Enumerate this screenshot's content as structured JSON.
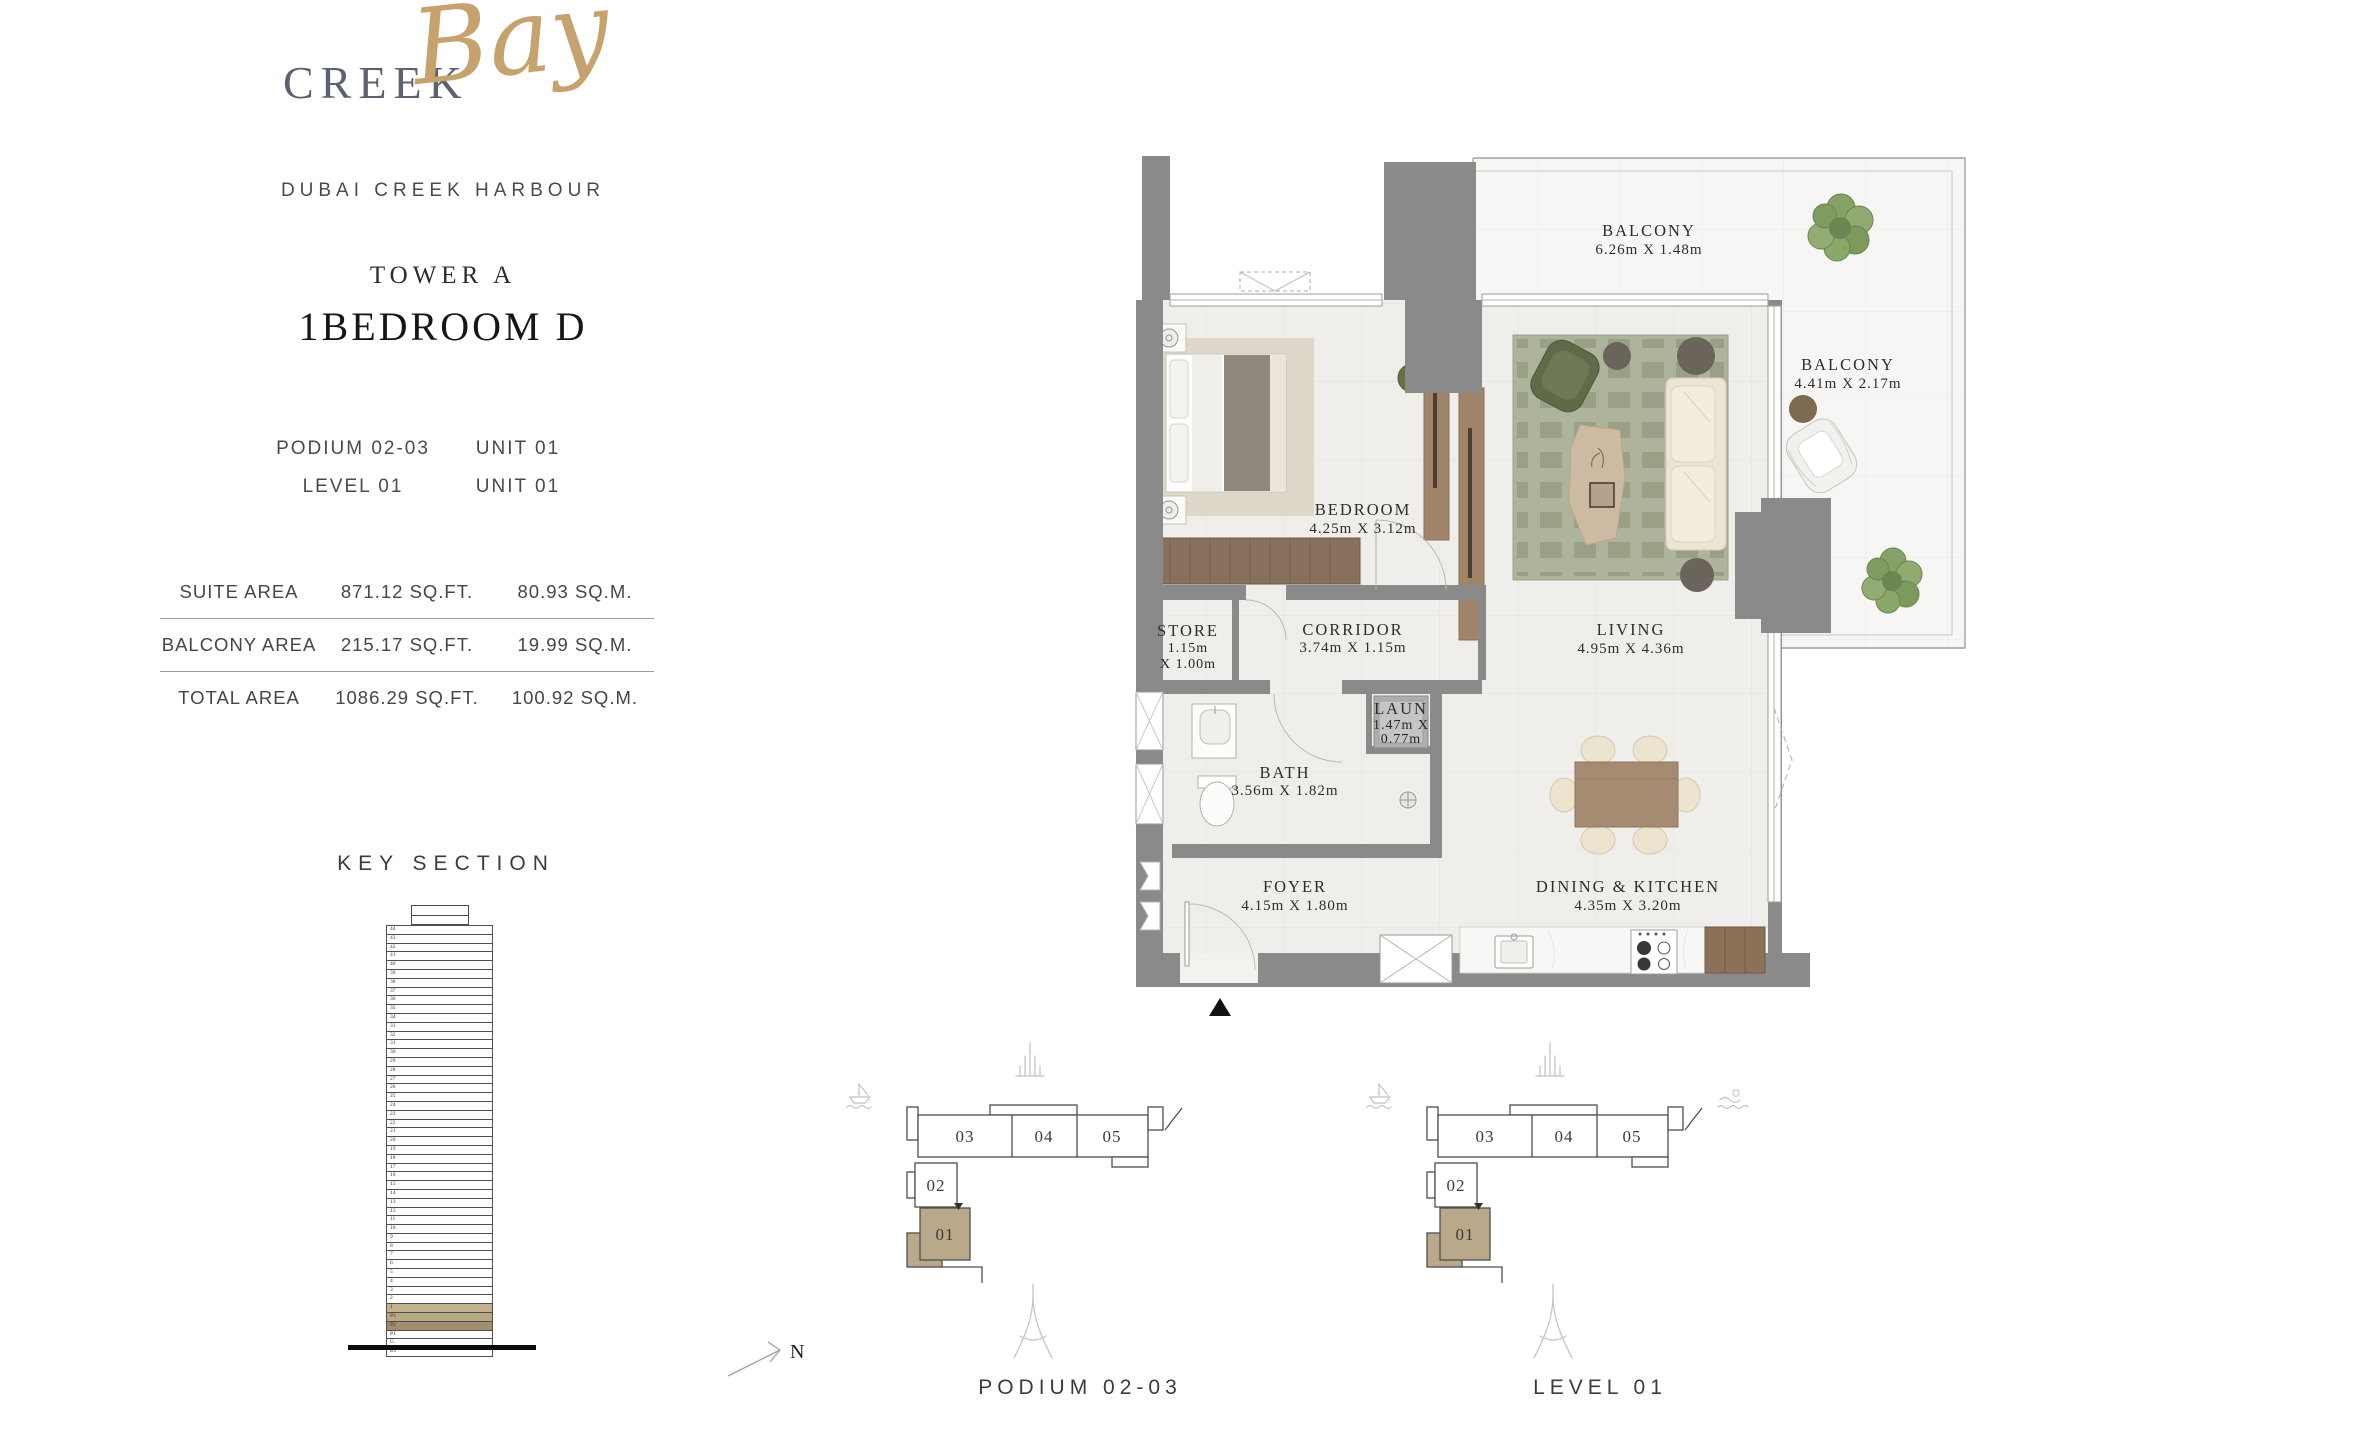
{
  "brand": {
    "name_primary": "CREEK",
    "name_script": "Bay",
    "subtitle": "DUBAI CREEK HARBOUR"
  },
  "unit": {
    "tower": "TOWER A",
    "type_label": "1BEDROOM D",
    "location_rows": [
      {
        "left": "PODIUM 02-03",
        "right": "UNIT 01"
      },
      {
        "left": "LEVEL 01",
        "right": "UNIT 01"
      }
    ]
  },
  "areas": {
    "rows": [
      {
        "label": "SUITE AREA",
        "sqft": "871.12 SQ.FT.",
        "sqm": "80.93 SQ.M."
      },
      {
        "label": "BALCONY AREA",
        "sqft": "215.17 SQ.FT.",
        "sqm": "19.99 SQ.M."
      },
      {
        "label": "TOTAL AREA",
        "sqft": "1086.29 SQ.FT.",
        "sqm": "100.92 SQ.M."
      }
    ]
  },
  "key_section": {
    "title": "KEY SECTION",
    "floors": [
      "44",
      "43",
      "42",
      "41",
      "40",
      "39",
      "38",
      "37",
      "36",
      "35",
      "34",
      "33",
      "32",
      "31",
      "30",
      "29",
      "28",
      "27",
      "26",
      "25",
      "24",
      "23",
      "22",
      "21",
      "20",
      "19",
      "18",
      "17",
      "16",
      "15",
      "14",
      "13",
      "12",
      "11",
      "10",
      "9",
      "8",
      "7",
      "6",
      "5",
      "4",
      "3",
      "2",
      "1",
      "P3",
      "P2",
      "P1",
      "G",
      "B1"
    ],
    "highlights": {
      "1": "#c2b18e",
      "P3": "#b9a884",
      "P2": "#a18e6e"
    }
  },
  "floor_plan": {
    "north_label": "N",
    "rooms": [
      {
        "name": "BALCONY",
        "dims": "6.26m X 1.48m"
      },
      {
        "name": "BALCONY",
        "dims": "4.41m X 2.17m"
      },
      {
        "name": "BEDROOM",
        "dims": "4.25m X 3.12m"
      },
      {
        "name": "STORE",
        "dims_l1": "1.15m",
        "dims_l2": "X 1.00m"
      },
      {
        "name": "CORRIDOR",
        "dims": "3.74m X 1.15m"
      },
      {
        "name": "LAUN",
        "dims_l1": "1.47m X",
        "dims_l2": "0.77m"
      },
      {
        "name": "BATH",
        "dims": "3.56m X 1.82m"
      },
      {
        "name": "LIVING",
        "dims": "4.95m X 4.36m"
      },
      {
        "name": "FOYER",
        "dims": "4.15m X 1.80m"
      },
      {
        "name": "DINING & KITCHEN",
        "dims": "4.35m X 3.20m"
      }
    ]
  },
  "keyplans": [
    {
      "label": "PODIUM 02-03",
      "highlighted_unit": "01",
      "units": [
        "01",
        "02",
        "03",
        "04",
        "05"
      ]
    },
    {
      "label": "LEVEL 01",
      "highlighted_unit": "01",
      "units": [
        "01",
        "02",
        "03",
        "04",
        "05"
      ]
    }
  ],
  "colors": {
    "accent_tan": "#b9a88a",
    "wall_gray": "#8a8a8a",
    "logo_gold": "#c6a36e",
    "logo_gray": "#5c6370",
    "rug_green": "#aeb39b",
    "wood_brown": "#8a7158",
    "plant_green": "#87a268",
    "text_dark": "#2e2d2a"
  }
}
